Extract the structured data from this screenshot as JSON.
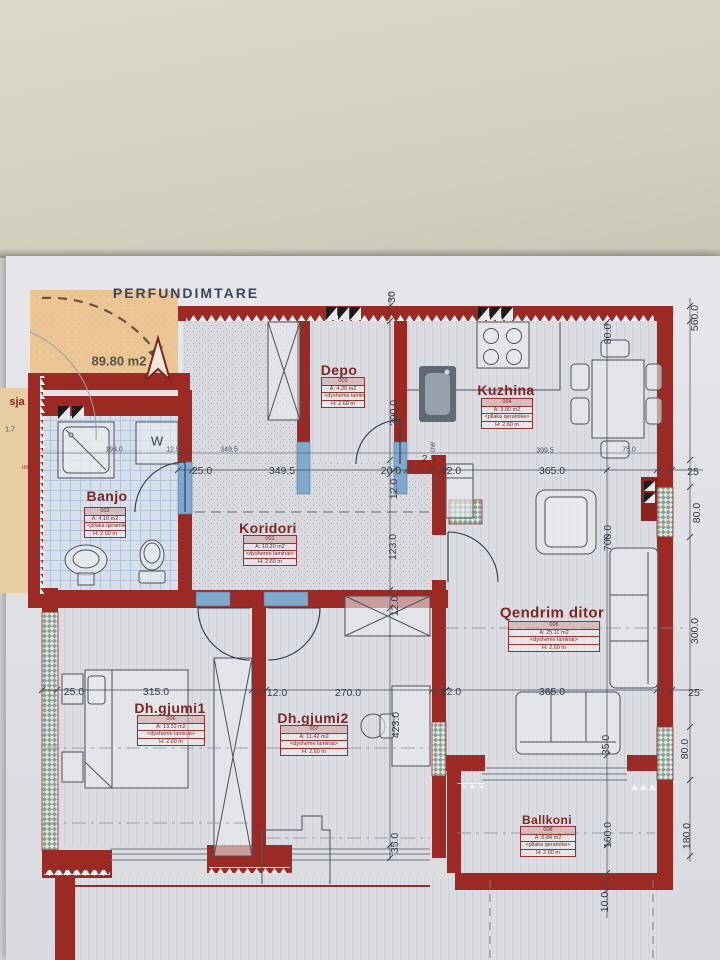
{
  "title": "PERFUNDIMTARE",
  "terrace": {
    "area": "89.80 m2"
  },
  "edge_fragments": {
    "f1": "sja",
    "f2": "1.7",
    "f3": "ima"
  },
  "labels": {
    "w": "W",
    "dw": "DW",
    "frigorifer": "Frigorifer"
  },
  "rooms": {
    "depo": {
      "name": "Depo",
      "rows": [
        "003",
        "A: 4.20 m2",
        "<dysheme laminat>",
        "H: 2.60 m"
      ]
    },
    "kuzhina": {
      "name": "Kuzhina",
      "rows": [
        "004",
        "A: 9.80 m2",
        "<pllaka qeramike>",
        "H: 2.60 m"
      ]
    },
    "banjo": {
      "name": "Banjo",
      "rows": [
        "002",
        "A: 4.10 m2",
        "<pllaka qeramike>",
        "H: 2.60 m"
      ]
    },
    "koridori": {
      "name": "Koridori",
      "rows": [
        "001",
        "A: 10.20 m2",
        "<dysheme laminat>",
        "H: 2.60 m"
      ]
    },
    "qendrim": {
      "name": "Qendrim ditor",
      "rows": [
        "005",
        "A: 25.11 m2",
        "<dysheme laminat>",
        "H: 2.60 m"
      ]
    },
    "gjumi1": {
      "name": "Dh.gjumi1",
      "rows": [
        "006",
        "A: 13.32 m2",
        "<dysheme laminat>",
        "H: 2.60 m"
      ]
    },
    "gjumi2": {
      "name": "Dh.gjumi2",
      "rows": [
        "007",
        "A: 11.42 m2",
        "<dysheme laminat>",
        "H: 2.60 m"
      ]
    },
    "ballkoni": {
      "name": "Ballkoni",
      "rows": [
        "008",
        "A: 5.84 m2",
        "<pllaka qeramike>",
        "H: 2.60 m"
      ]
    }
  },
  "dims": {
    "a1": "25.0",
    "a2": "349.5",
    "a3": "20.0",
    "a4": "2.5",
    "a5": "12.0",
    "a6": "365.0",
    "a7": "25",
    "s1": "193.0",
    "s2": "12.5",
    "s3": "349.5",
    "s4": "399.5",
    "s5": "75.0",
    "b1": "25.0",
    "b2": "315.0",
    "b3": "12.0",
    "b4": "270.0",
    "b5": "12.0",
    "b6": "365.0",
    "b7": "25",
    "m1": "30",
    "m2": "290.0",
    "m3": "12.0",
    "m4": "123.0",
    "m5": "12.0",
    "m6": "423.0",
    "m7": "35.0",
    "k1": "80.0",
    "k2": "700.0",
    "k3": "35.0",
    "k4": "160.0",
    "k5": "10.0",
    "r1": "560.0",
    "r2": "80.0",
    "r3": "300.0",
    "r4": "80.0",
    "r5": "180.0"
  }
}
